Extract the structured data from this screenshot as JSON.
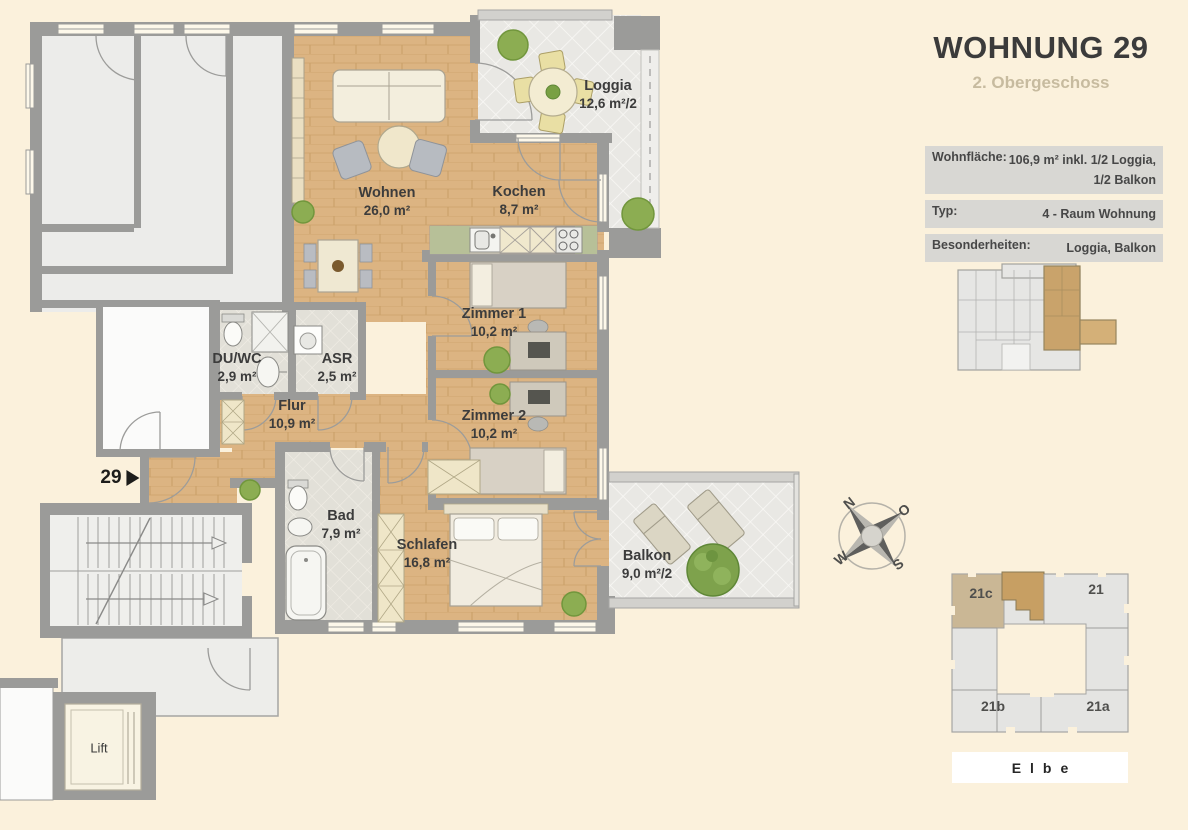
{
  "header": {
    "title": "WOHNUNG 29",
    "subtitle": "2. Obergeschoss"
  },
  "info_table": {
    "rows": [
      {
        "label": "Wohnfläche:",
        "value": "106,9 m² inkl. 1/2 Loggia,",
        "value2": "1/2 Balkon"
      },
      {
        "label": "Typ:",
        "value": "4 - Raum Wohnung"
      },
      {
        "label": "Besonderheiten:",
        "value": "Loggia, Balkon"
      }
    ]
  },
  "floor_plan": {
    "unit_marker": "29",
    "lift_label": "Lift",
    "rooms": [
      {
        "name": "Wohnen",
        "area": "26,0 m²"
      },
      {
        "name": "Kochen",
        "area": "8,7 m²"
      },
      {
        "name": "Loggia",
        "area": "12,6 m²/2"
      },
      {
        "name": "Zimmer 1",
        "area": "10,2 m²"
      },
      {
        "name": "Zimmer 2",
        "area": "10,2 m²"
      },
      {
        "name": "DU/WC",
        "area": "2,9 m²"
      },
      {
        "name": "ASR",
        "area": "2,5 m²"
      },
      {
        "name": "Flur",
        "area": "10,9 m²"
      },
      {
        "name": "Bad",
        "area": "7,9 m²"
      },
      {
        "name": "Schlafen",
        "area": "16,8 m²"
      },
      {
        "name": "Balkon",
        "area": "9,0 m²/2"
      }
    ]
  },
  "compass": {
    "north": "N",
    "east": "O",
    "south": "S",
    "west": "W"
  },
  "site_plan": {
    "buildings": [
      "21c",
      "21",
      "21b",
      "21a"
    ],
    "river": "Elbe"
  },
  "colors": {
    "background": "#fbf1dc",
    "wall": "#9b9b99",
    "wood": "#dcb482",
    "unit_highlight": "#c79f63",
    "table_row": "#d8d7d3",
    "subtitle": "#c7bb9f"
  }
}
